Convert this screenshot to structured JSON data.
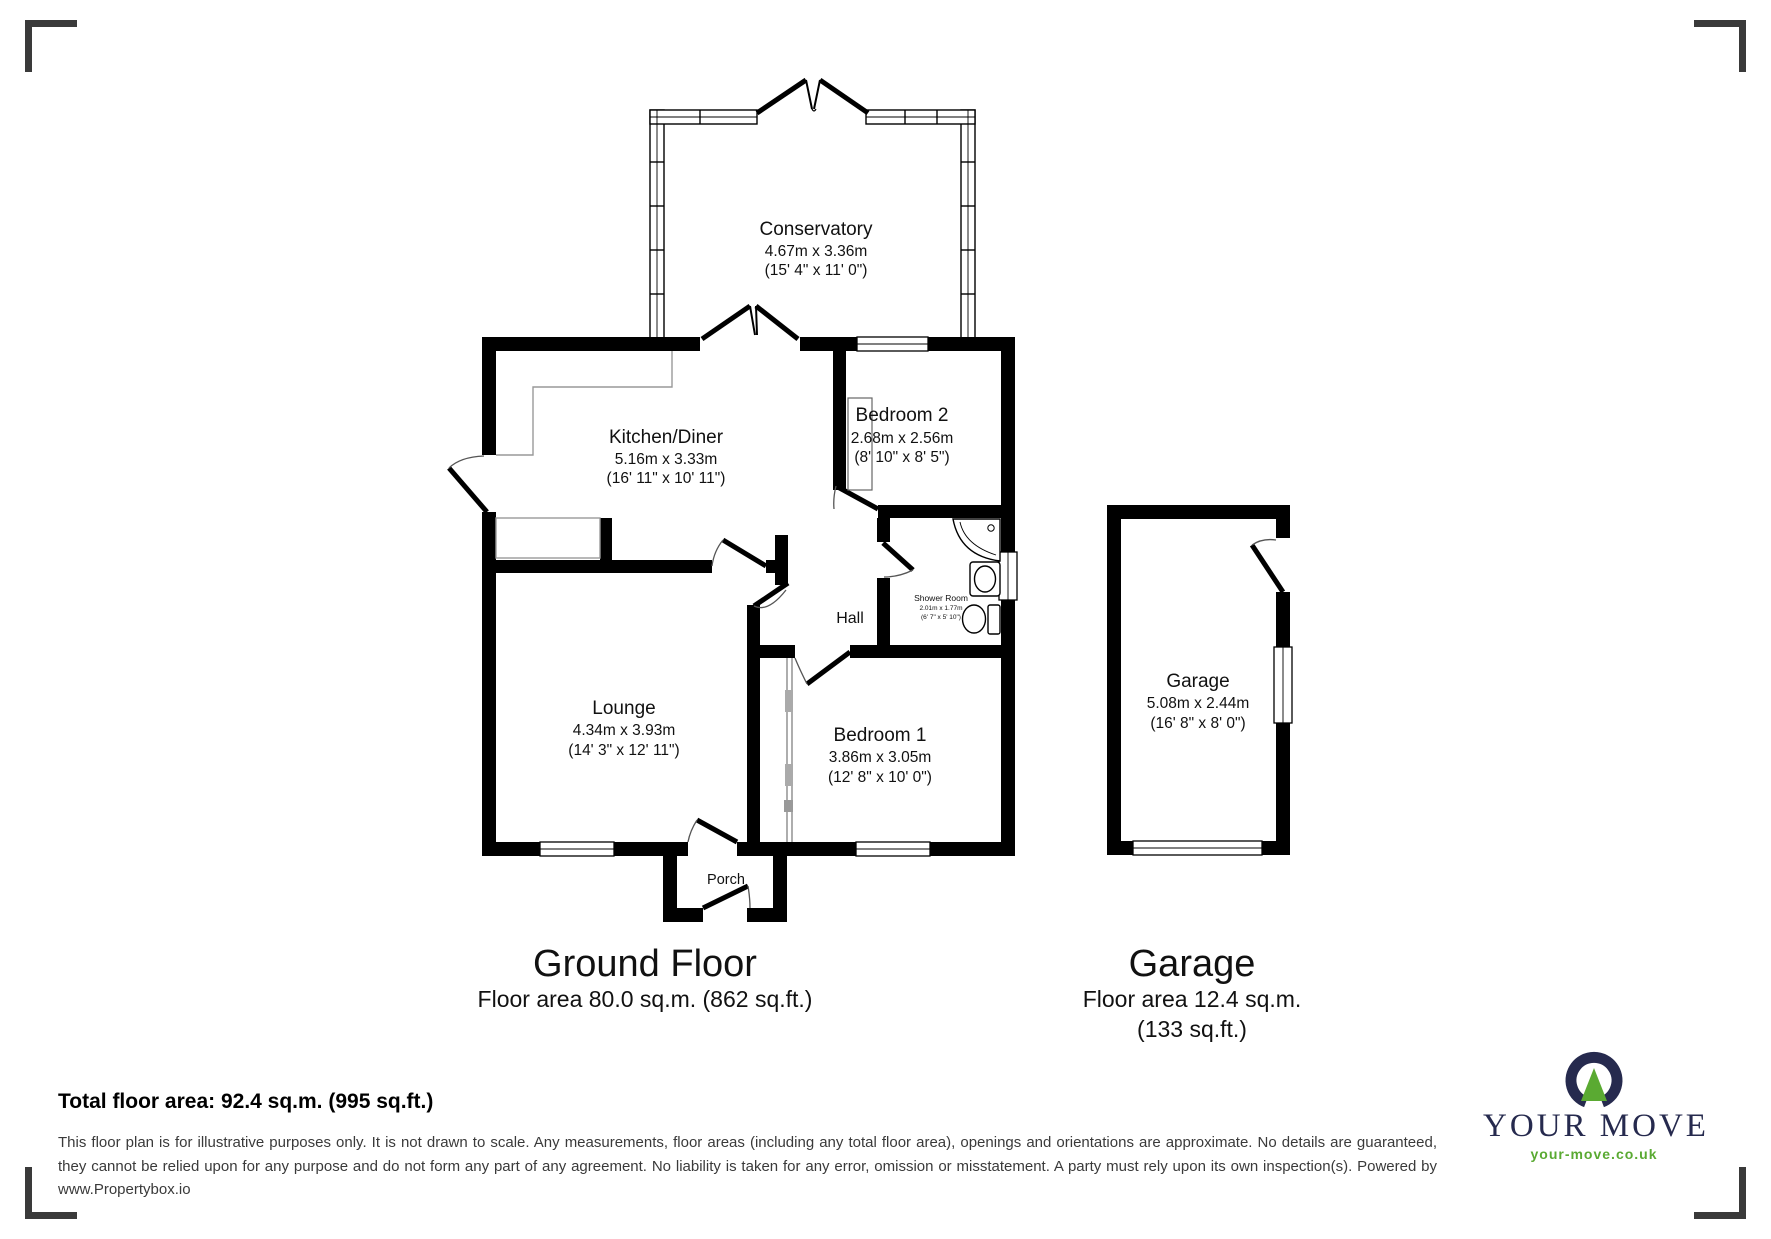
{
  "rooms": {
    "conservatory": {
      "name": "Conservatory",
      "metric": "4.67m x 3.36m",
      "imperial": "(15' 4\" x 11' 0\")"
    },
    "kitchen": {
      "name": "Kitchen/Diner",
      "metric": "5.16m x 3.33m",
      "imperial": "(16' 11\" x 10' 11\")"
    },
    "bedroom2": {
      "name": "Bedroom 2",
      "metric": "2.68m x 2.56m",
      "imperial": "(8' 10\" x 8' 5\")"
    },
    "shower": {
      "name": "Shower Room",
      "metric": "2.01m x 1.77m",
      "imperial": "(6' 7\" x 5' 10\")"
    },
    "hall": {
      "name": "Hall"
    },
    "lounge": {
      "name": "Lounge",
      "metric": "4.34m x 3.93m",
      "imperial": "(14' 3\" x 12' 11\")"
    },
    "bedroom1": {
      "name": "Bedroom 1",
      "metric": "3.86m x 3.05m",
      "imperial": "(12' 8\" x 10' 0\")"
    },
    "porch": {
      "name": "Porch"
    },
    "garage": {
      "name": "Garage",
      "metric": "5.08m x 2.44m",
      "imperial": "(16' 8\" x 8' 0\")"
    }
  },
  "captions": {
    "ground_floor": {
      "title": "Ground Floor",
      "area": "Floor area 80.0 sq.m. (862 sq.ft.)"
    },
    "garage": {
      "title": "Garage",
      "area_line1": "Floor area 12.4 sq.m.",
      "area_line2": "(133 sq.ft.)"
    }
  },
  "footer": {
    "total": "Total floor area: 92.4 sq.m. (995 sq.ft.)",
    "disclaimer": "This floor plan is for illustrative purposes only. It is not drawn to scale. Any measurements, floor areas (including any total floor area), openings and orientations are approximate. No details are guaranteed, they cannot be relied upon for any purpose and do not form any part of any agreement. No liability is taken for any error, omission or misstatement. A party must rely upon its own inspection(s). Powered by www.Propertybox.io"
  },
  "logo": {
    "brand": "YOUR MOVE",
    "url": "your-move.co.uk",
    "navy": "#262a4e",
    "green": "#5aaa32"
  }
}
